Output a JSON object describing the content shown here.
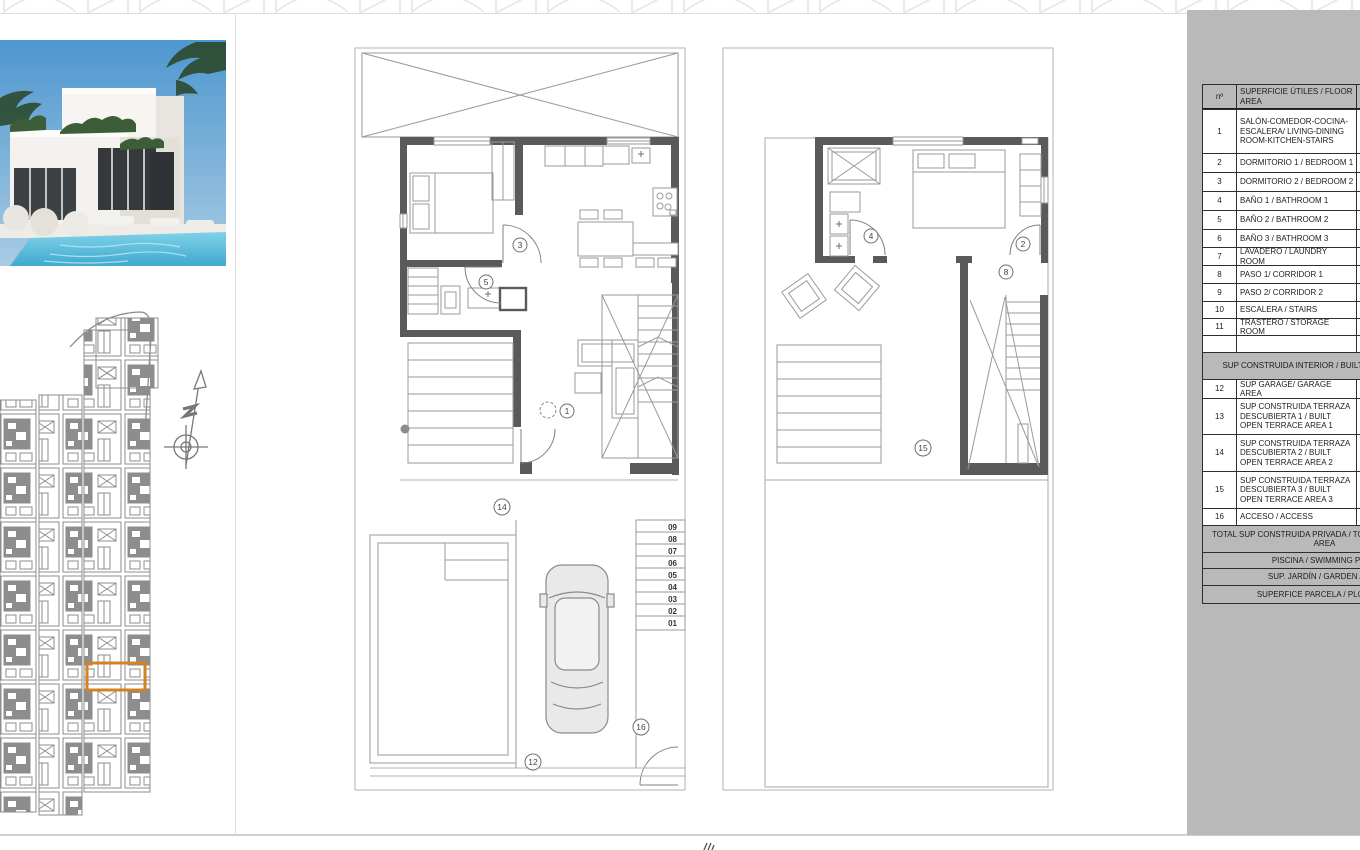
{
  "colors": {
    "sidebar_bg": "#b9b9b9",
    "wall_dark": "#5a5a5a",
    "plan_line": "#909090",
    "site_gray": "#8d8d8d",
    "highlight_orange": "#d4831f",
    "pool_blue": "#55bedd"
  },
  "area_table": {
    "header_no": "nº",
    "header_label": "SUPERFICIE ÚTILES / FLOOR AREA",
    "rows1": [
      {
        "no": "1",
        "label": "SALÓN-COMEDOR-COCINA-ESCALERA/ LIVING-DINING ROOM-KITCHEN-STAIRS"
      },
      {
        "no": "2",
        "label": "DORMITORIO 1 / BEDROOM 1"
      },
      {
        "no": "3",
        "label": "DORMITORIO 2 / BEDROOM 2"
      },
      {
        "no": "4",
        "label": "BAÑO 1 / BATHROOM 1"
      },
      {
        "no": "5",
        "label": "BAÑO 2 / BATHROOM 2"
      },
      {
        "no": "6",
        "label": "BAÑO 3 / BATHROOM 3"
      },
      {
        "no": "7",
        "label": "LAVADERO / LAUNDRY ROOM"
      },
      {
        "no": "8",
        "label": "PASO 1/ CORRIDOR 1"
      },
      {
        "no": "9",
        "label": "PASO 2/ CORRIDOR 2"
      },
      {
        "no": "10",
        "label": "ESCALERA / STAIRS"
      },
      {
        "no": "11",
        "label": "TRASTERO / STORAGE ROOM"
      }
    ],
    "interior_header": "SUP CONSTRUIDA INTERIOR / BUILT INTERIOR AREA",
    "rows2": [
      {
        "no": "12",
        "label": "SUP GARAGE/ GARAGE AREA"
      },
      {
        "no": "13",
        "label": "SUP CONSTRUIDA TERRAZA DESCUBIERTA 1 / BUILT OPEN TERRACE AREA 1"
      },
      {
        "no": "14",
        "label": "SUP CONSTRUIDA TERRAZA DESCUBIERTA 2 / BUILT OPEN TERRACE AREA 2"
      },
      {
        "no": "15",
        "label": "SUP CONSTRUIDA TERRAZA DESCUBIERTA 3 / BUILT OPEN TERRACE AREA 3"
      },
      {
        "no": "16",
        "label": "ACCESO / ACCESS"
      }
    ],
    "total_label": "TOTAL SUP CONSTRUIDA PRIVADA / TOTAL BUILT PRIVATE AREA",
    "pool_label": "PISCINA / SWIMMING POOL",
    "garden_label": "SUP. JARDÍN / GARDEN AREA",
    "plot_label": "SUPERFICE PARCELA / PLOT AREA"
  },
  "plans": {
    "ground_floor": {
      "labels": {
        "l1": "1",
        "l3": "3",
        "l5": "5",
        "l12": "12",
        "l14": "14",
        "l16": "16"
      },
      "stair_steps": [
        "09",
        "08",
        "07",
        "06",
        "05",
        "04",
        "03",
        "02",
        "01"
      ]
    },
    "first_floor": {
      "labels": {
        "l2": "2",
        "l4": "4",
        "l8": "8",
        "l15": "15"
      }
    }
  }
}
